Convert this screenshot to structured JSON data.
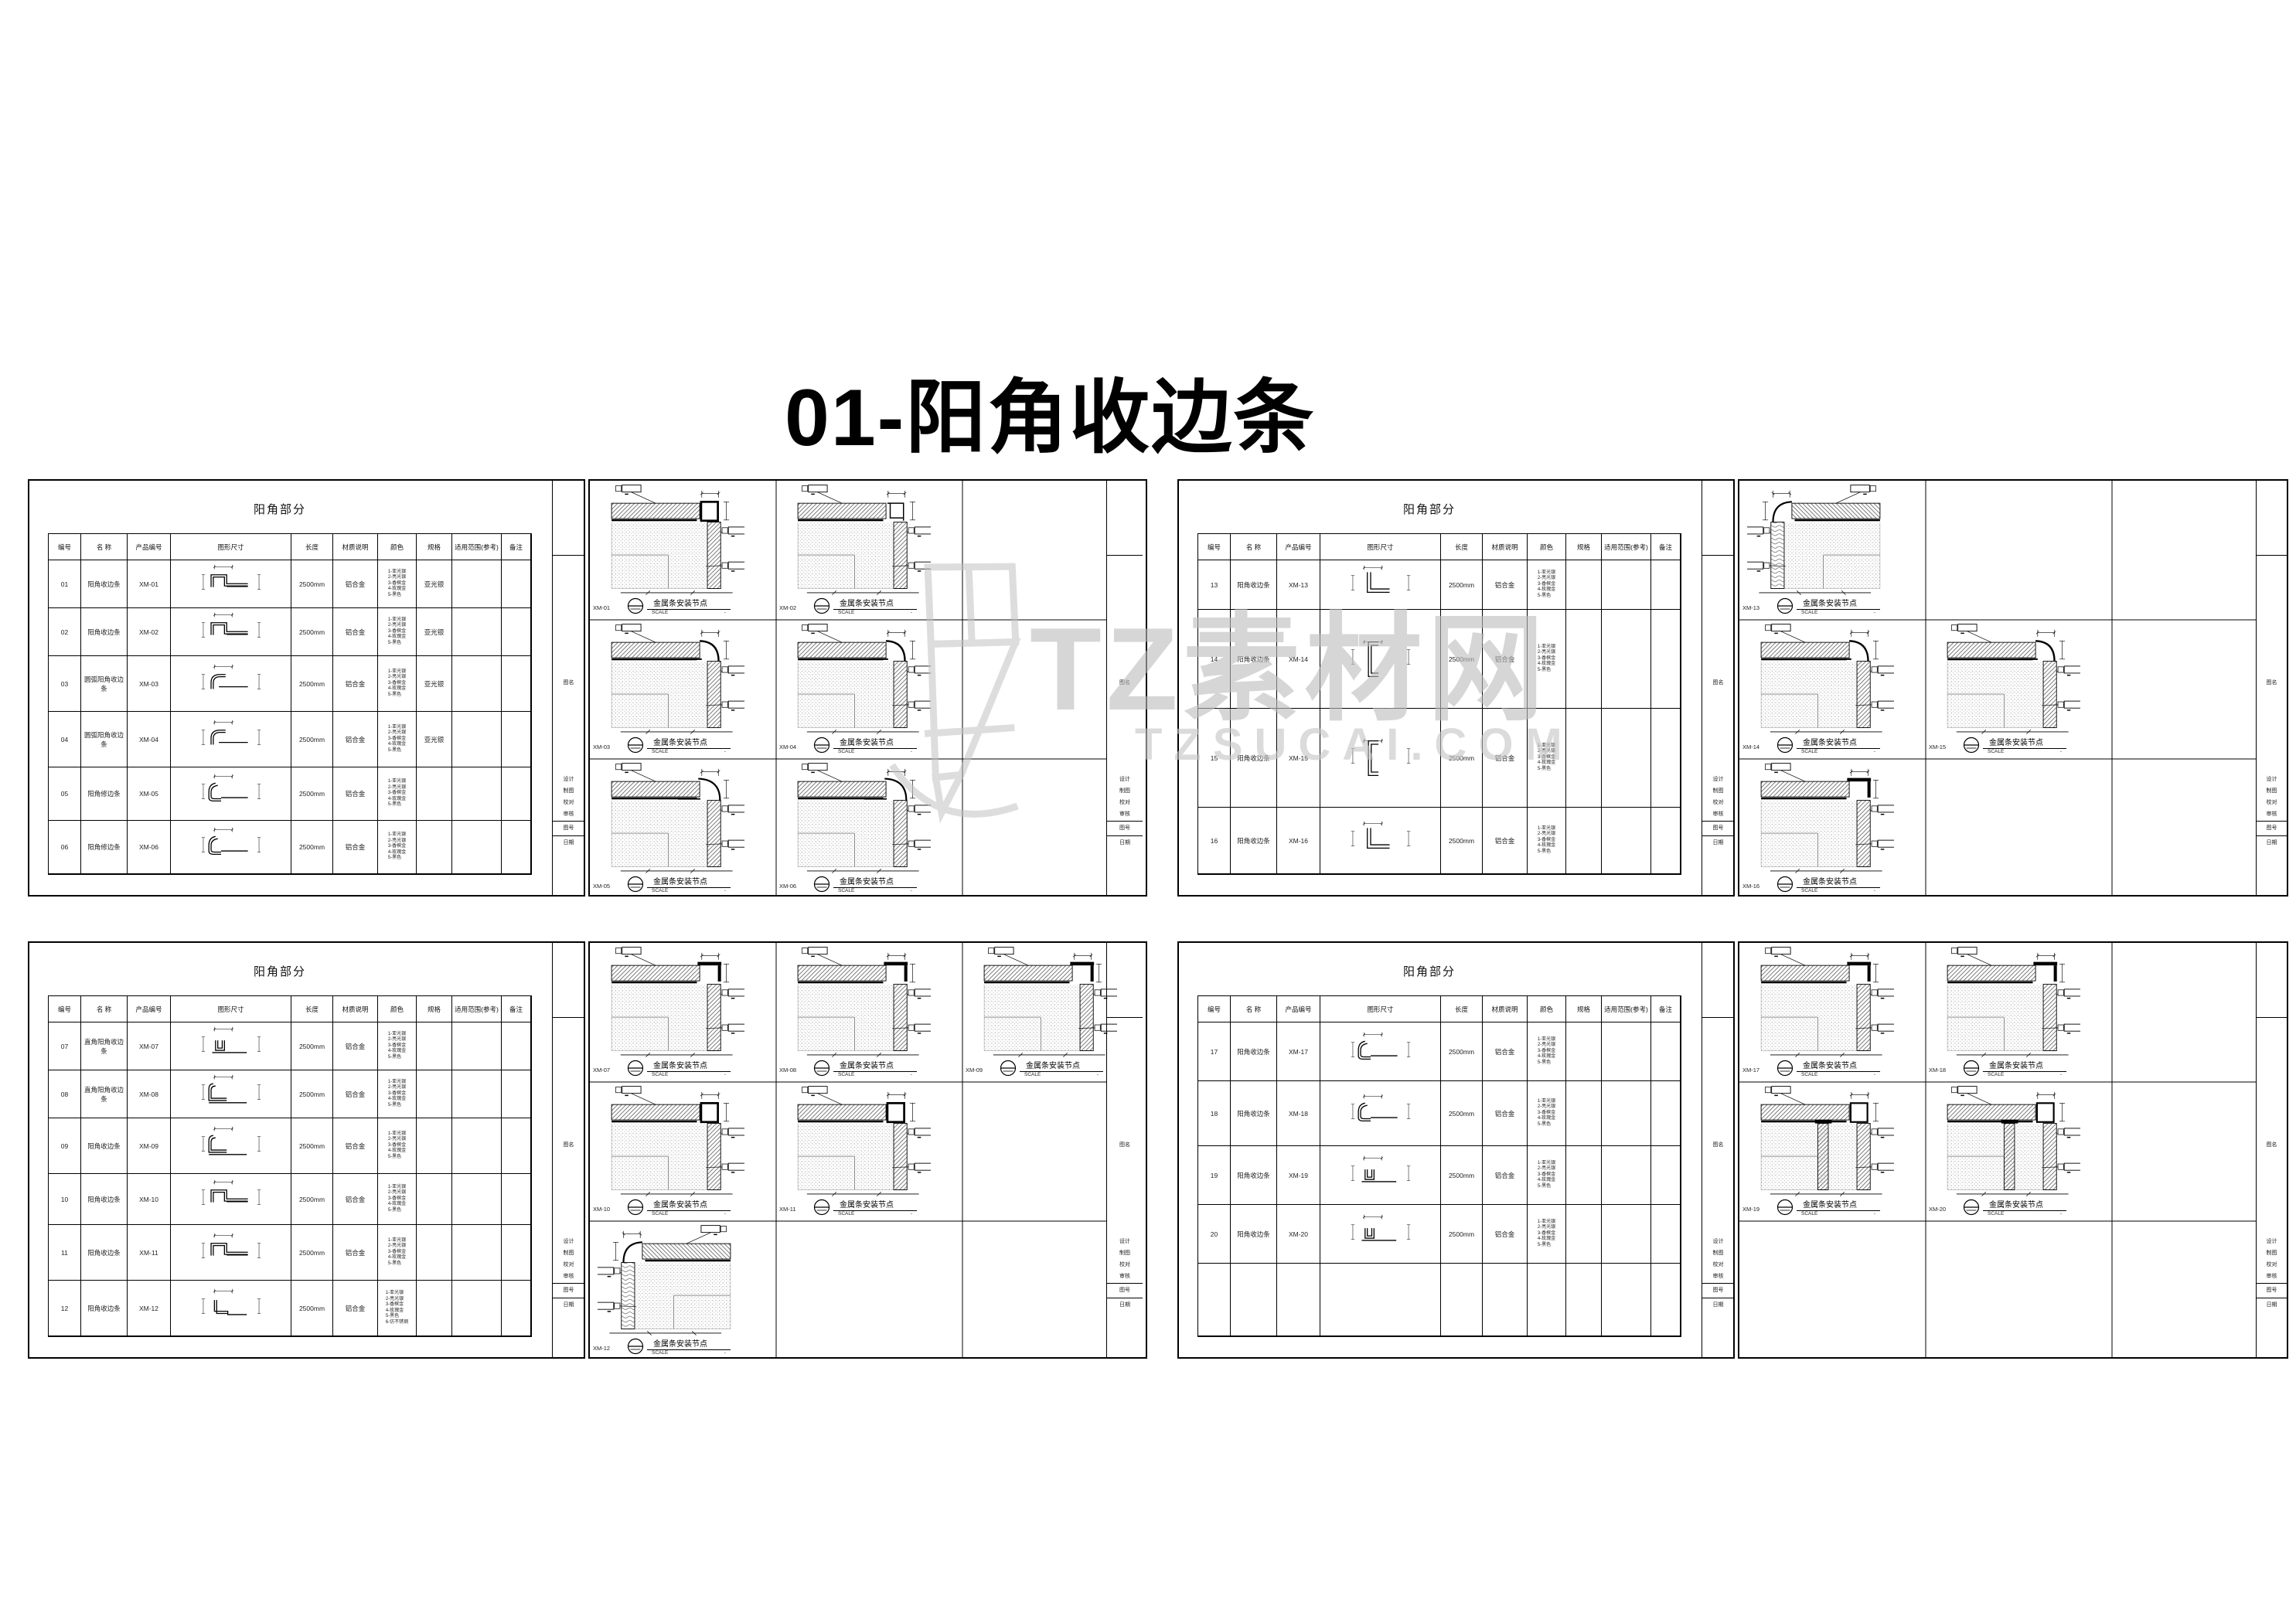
{
  "page": {
    "title": "01-阳角收边条"
  },
  "watermark": {
    "brand": "TZ素材网",
    "domain": "TZSUCAI.COM",
    "color": "#bdbdbd"
  },
  "sheet": {
    "panel_title": "阳角部分",
    "columns": [
      "编号",
      "名 称",
      "产品编号",
      "图形尺寸",
      "长度",
      "材质说明",
      "颜色",
      "规格",
      "适用范围(参考)",
      "备注"
    ],
    "caption_title": "金属条安装节点",
    "caption_scale_label": "SCALE",
    "caption_scale_value": "-",
    "colors": [
      "1-亚光银",
      "2-亮光银",
      "3-香槟金",
      "4-玫瑰金",
      "5-黑色"
    ],
    "titleblock": [
      "设计",
      "制图",
      "校对",
      "审核"
    ],
    "titleblock_no": "图号",
    "titleblock_date": "日期",
    "titleblock_name": "图名"
  },
  "quadrants": [
    {
      "name": "top-left",
      "rows": [
        {
          "no": "01",
          "name": "阳角收边条",
          "code": "XM-01",
          "profile": "u-flange",
          "length": "2500mm",
          "material": "铝合金",
          "spec": "亚光银"
        },
        {
          "no": "02",
          "name": "阳角收边条",
          "code": "XM-02",
          "profile": "u-flange",
          "length": "2500mm",
          "material": "铝合金",
          "spec": "亚光银"
        },
        {
          "no": "03",
          "name": "圆弧阳角收边条",
          "code": "XM-03",
          "profile": "quarter",
          "length": "2500mm",
          "material": "铝合金",
          "spec": "亚光银"
        },
        {
          "no": "04",
          "name": "圆弧阳角收边条",
          "code": "XM-04",
          "profile": "quarter",
          "length": "2500mm",
          "material": "铝合金",
          "spec": "亚光银"
        },
        {
          "no": "05",
          "name": "阳角修边条",
          "code": "XM-05",
          "profile": "j-curve",
          "length": "2500mm",
          "material": "铝合金",
          "spec": ""
        },
        {
          "no": "06",
          "name": "阳角修边条",
          "code": "XM-06",
          "profile": "j-curve",
          "length": "2500mm",
          "material": "铝合金",
          "spec": ""
        }
      ],
      "details": [
        {
          "code": "XM-01",
          "row": 0,
          "col": 0,
          "variant": "sq"
        },
        {
          "code": "XM-02",
          "row": 0,
          "col": 1,
          "variant": "ch"
        },
        {
          "code": "XM-03",
          "row": 1,
          "col": 0,
          "variant": "rd"
        },
        {
          "code": "XM-04",
          "row": 1,
          "col": 1,
          "variant": "rd"
        },
        {
          "code": "XM-05",
          "row": 2,
          "col": 0,
          "variant": "bn"
        },
        {
          "code": "XM-06",
          "row": 2,
          "col": 1,
          "variant": "bn"
        }
      ]
    },
    {
      "name": "top-right",
      "rows": [
        {
          "no": "13",
          "name": "阳角收边条",
          "code": "XM-13",
          "profile": "L",
          "length": "2500mm",
          "material": "铝合金",
          "spec": ""
        },
        {
          "no": "14",
          "name": "阳角收边条",
          "code": "XM-14",
          "profile": "c-tall",
          "length": "2500mm",
          "material": "铝合金",
          "spec": ""
        },
        {
          "no": "15",
          "name": "阳角收边条",
          "code": "XM-15",
          "profile": "c-tall",
          "length": "2500mm",
          "material": "铝合金",
          "spec": ""
        },
        {
          "no": "16",
          "name": "阳角收边条",
          "code": "XM-16",
          "profile": "L",
          "length": "2500mm",
          "material": "铝合金",
          "spec": ""
        }
      ],
      "details": [
        {
          "code": "XM-13",
          "row": 0,
          "col": 0,
          "variant": "wood"
        },
        {
          "code": "XM-14",
          "row": 1,
          "col": 0,
          "variant": "rd"
        },
        {
          "code": "XM-15",
          "row": 1,
          "col": 1,
          "variant": "rd"
        },
        {
          "code": "XM-16",
          "row": 2,
          "col": 0,
          "variant": "flat"
        }
      ]
    },
    {
      "name": "bottom-left",
      "rows": [
        {
          "no": "07",
          "name": "直角阳角收边条",
          "code": "XM-07",
          "profile": "u-small",
          "length": "2500mm",
          "material": "铝合金",
          "spec": ""
        },
        {
          "no": "08",
          "name": "直角阳角收边条",
          "code": "XM-08",
          "profile": "L-round",
          "length": "2500mm",
          "material": "铝合金",
          "spec": ""
        },
        {
          "no": "09",
          "name": "阳角收边条",
          "code": "XM-09",
          "profile": "L-round",
          "length": "2500mm",
          "material": "铝合金",
          "spec": ""
        },
        {
          "no": "10",
          "name": "阳角收边条",
          "code": "XM-10",
          "profile": "u-flange",
          "length": "2500mm",
          "material": "铝合金",
          "spec": ""
        },
        {
          "no": "11",
          "name": "阳角收边条",
          "code": "XM-11",
          "profile": "u-flange",
          "length": "2500mm",
          "material": "铝合金",
          "spec": ""
        },
        {
          "no": "12",
          "name": "阳角收边条",
          "code": "XM-12",
          "profile": "l-step",
          "length": "2500mm",
          "material": "铝合金",
          "spec": "",
          "extra_color": "6-仿不锈钢"
        }
      ],
      "details": [
        {
          "code": "XM-07",
          "row": 0,
          "col": 0,
          "variant": "flat"
        },
        {
          "code": "XM-08",
          "row": 0,
          "col": 1,
          "variant": "flat"
        },
        {
          "code": "XM-09",
          "row": 0,
          "col": 2,
          "variant": "flat"
        },
        {
          "code": "XM-10",
          "row": 1,
          "col": 0,
          "variant": "sq"
        },
        {
          "code": "XM-11",
          "row": 1,
          "col": 1,
          "variant": "sq"
        },
        {
          "code": "XM-12",
          "row": 2,
          "col": 0,
          "variant": "wood"
        }
      ]
    },
    {
      "name": "bottom-right",
      "rows": [
        {
          "no": "17",
          "name": "阳角收边条",
          "code": "XM-17",
          "profile": "j-curve",
          "length": "2500mm",
          "material": "铝合金",
          "spec": ""
        },
        {
          "no": "18",
          "name": "阳角收边条",
          "code": "XM-18",
          "profile": "j-curve",
          "length": "2500mm",
          "material": "铝合金",
          "spec": ""
        },
        {
          "no": "19",
          "name": "阳角收边条",
          "code": "XM-19",
          "profile": "u-small",
          "length": "2500mm",
          "material": "铝合金",
          "spec": ""
        },
        {
          "no": "20",
          "name": "阳角收边条",
          "code": "XM-20",
          "profile": "u-small",
          "length": "2500mm",
          "material": "铝合金",
          "spec": ""
        }
      ],
      "details": [
        {
          "code": "XM-17",
          "row": 0,
          "col": 0,
          "variant": "flat"
        },
        {
          "code": "XM-18",
          "row": 0,
          "col": 1,
          "variant": "flat"
        },
        {
          "code": "XM-19",
          "row": 1,
          "col": 0,
          "variant": "colv"
        },
        {
          "code": "XM-20",
          "row": 1,
          "col": 1,
          "variant": "colv"
        }
      ]
    }
  ]
}
